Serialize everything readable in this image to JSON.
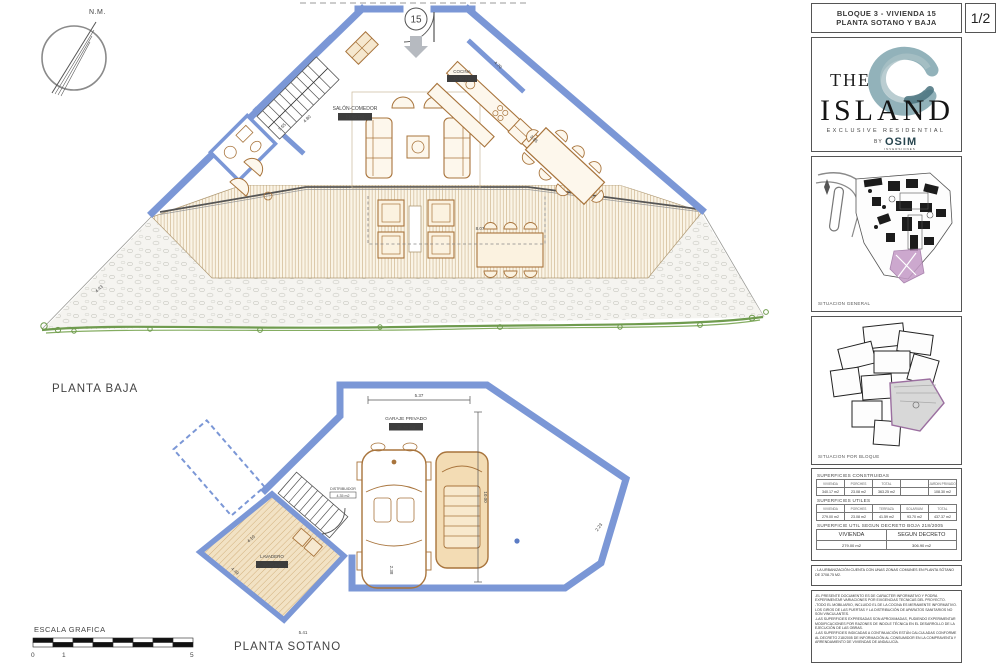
{
  "titleblock": {
    "line1": "BLOQUE 3 - VIVIENDA 15",
    "line2": "PLANTA SOTANO Y BAJA",
    "page": "1/2"
  },
  "logo": {
    "the": "THE",
    "island": "ISLAND",
    "tagline": "EXCLUSIVE RESIDENTIAL",
    "by": "BY",
    "brand": "OSIM",
    "brand_sub": "INVERSIONES"
  },
  "maps": {
    "general_label": "SITUACION GENERAL",
    "bloque_label": "SITUACION POR BLOQUE"
  },
  "tables": {
    "constructed": {
      "title": "SUPERFICIES CONSTRUIDAS",
      "headers": [
        "VIVIENDA",
        "PORCHES",
        "TOTAL",
        "",
        "JARDIN PRIVADO"
      ],
      "values": [
        "340.17 m2",
        "23.08 m2",
        "363.25 m2",
        "",
        "108.30 m2"
      ]
    },
    "useful": {
      "title": "SUPERFICIES UTILES",
      "headers": [
        "VIVIENDA",
        "PORCHES",
        "TERRAZA",
        "SOLARIUM",
        "TOTAL"
      ],
      "values": [
        "279.00 m2",
        "23.08 m2",
        "41.59 m2",
        "93.70 m2",
        "437.37 m2"
      ]
    },
    "decree": {
      "title": "SUPERFICIE UTIL SEGUN DECRETO BOJA 218/2005",
      "headers": [
        "VIVIENDA",
        "SEGUN DECRETO"
      ],
      "values": [
        "279.00 m2",
        "306.90 m2"
      ]
    }
  },
  "notes": {
    "common_zones": "- LA URBANIZACIÓN CUENTA CON UNAS ZONAS COMUNES EN PLANTA SÓTANO DE 3708.75 M2."
  },
  "disclaimer": {
    "lines": [
      "-EL PRESENTE DOCUMENTO ES DE CARACTER INFORMATIVO Y PODRA EXPERIMENTAR VARIACIONES POR EXIGENCIAS TECNICAS DEL PROYECTO.",
      "-TODO EL MOBILIARIO, INCLUIDO EL DE LA COCINA ES MERAMENTE INFORMATIVO. LOS GIROS DE LAS PUERTAS Y LA DISTRIBUCIÓN DE APARATOS SANITARIOS NO SON VINCULANTES.",
      "-LAS SUPERFICIES EXPRESADAS SON APROXIMADAS, PUDIENDO EXPERIMENTAR MODIFICACIONES POR RAZONES DE INDOLE TÉCNICA EN EL DESARROLLO DE LA EJECUCIÓN DE LAS OBRAS.",
      "-LAS SUPERFICIES INDICADAS A CONTINUACIÓN ESTÁN CALCULADAS CONFORME AL DECRETO 218/2005 DE INFORMACIÓN AL CONSUMIDOR EN LA COMPRAVENTA Y ARRENDAMIENTO DE VIVIENDAS DE ANDALUCÍA."
    ]
  },
  "plans": {
    "baja": {
      "label": "PLANTA BAJA",
      "entrance_number": "15",
      "salon_label": "SALÓN-COMEDOR",
      "salon_area": "51.95 m2",
      "cocina_label": "COCINA",
      "cocina_area": "16.50 m2",
      "dims": {
        "d1": "4.70",
        "d2": "8.07",
        "d3": "7.65",
        "d4": "4.80",
        "d5": "3.95",
        "d6": "4.43"
      }
    },
    "sotano": {
      "label": "PLANTA SOTANO",
      "garaje_label": "GARAJE PRIVADO",
      "garaje_area": "48.76 m2",
      "lavadero_label": "LAVADERO",
      "lavadero_area": "26.25 m2",
      "distribuidor_label": "DISTRIBUIDOR",
      "distribuidor_area": "4.35 m2",
      "dims": {
        "d1": "5.37",
        "d2": "10.00",
        "d3": "4.10",
        "d4": "4.49",
        "d5": "2.38",
        "d6": "5.41",
        "d7": "2.23"
      }
    }
  },
  "compass": {
    "label": "N.M."
  },
  "scale": {
    "label": "ESCALA GRAFICA",
    "tick0": "0",
    "tick1": "1",
    "tick5": "5"
  },
  "colors": {
    "wall_blue": "#7b97d6",
    "furniture_tan": "#a8743c",
    "deck_line": "#c9ad84",
    "vegetation_green": "#6f9b4e",
    "highlight_magenta": "#c49ac6",
    "logo_teal": "#6e98a3"
  }
}
